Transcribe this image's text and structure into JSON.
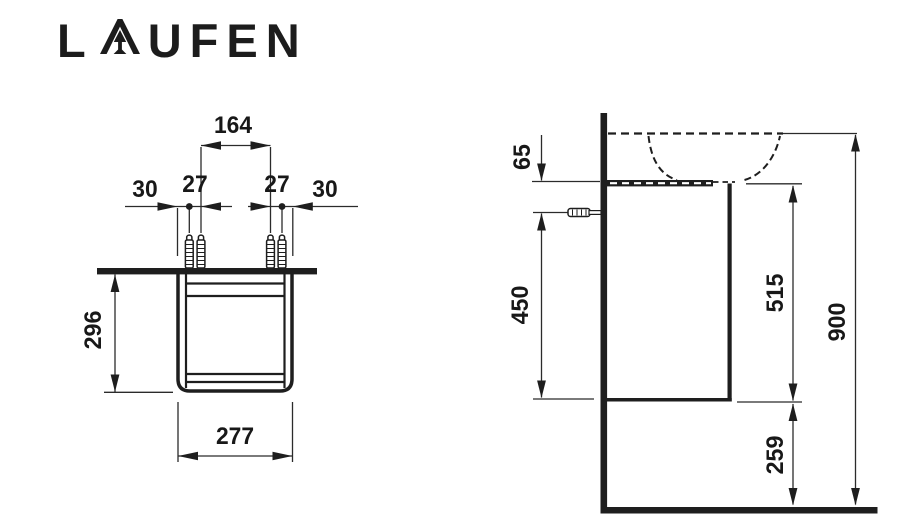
{
  "brand": {
    "name": "LAUFEN",
    "logo_prefix": "L",
    "logo_suffix": "UFEN"
  },
  "drawing": {
    "front_view": {
      "dimensions": {
        "fixing_centres": "164",
        "left_edge_offset": "30",
        "left_screw_pair": "27",
        "right_screw_pair": "27",
        "right_edge_offset": "30",
        "carcase_height": "296",
        "carcase_width": "277"
      }
    },
    "side_view": {
      "dimensions": {
        "rim_to_carcase_top": "65",
        "fixing_height": "450",
        "carcase_top_height": "515",
        "rim_height": "900",
        "floor_clearance": "259"
      }
    },
    "colors": {
      "line": "#1e1e1e",
      "background": "#ffffff"
    }
  }
}
